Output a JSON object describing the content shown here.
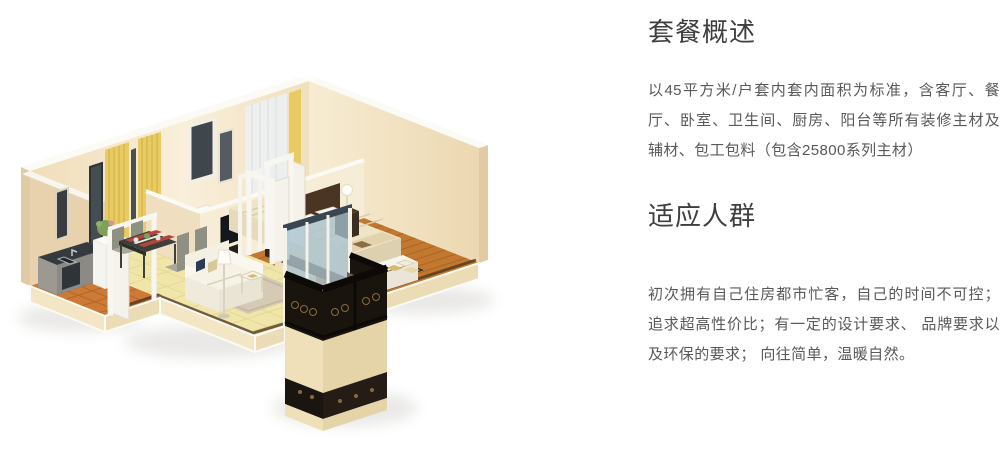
{
  "page": {
    "background": "#ffffff"
  },
  "floor_plan": {
    "alt": "3D isometric rendering of a 45 square meter apartment: kitchen, dining area, living room, bathroom, two bedrooms and a balcony with black wrought-iron railing",
    "colors": {
      "wall": "#f3e5c8",
      "wall_top": "#fbfaf5",
      "tile_floor": "#f1e6aa",
      "kitchen_tile": "#cd7a36",
      "wood_floor": "#c2792f",
      "bath_tile": "#e0a258",
      "curtain": "#e6c75f",
      "railing": "#17110c",
      "bed_linen": "#efe4c6",
      "rug_dark": "#53361f"
    }
  },
  "sections": [
    {
      "heading": "套餐概述",
      "body": "以45平方米/户套内套内面积为标准，含客厅、餐厅、卧室、卫生间、厨房、阳台等所有装修主材及辅材、包工包料（包含25800系列主材）"
    },
    {
      "heading": "适应人群",
      "body": "初次拥有自己住房都市忙客，自己的时间不可控；追求超高性价比；有一定的设计要求、 品牌要求以及环保的要求； 向往简单，温暖自然。"
    }
  ]
}
